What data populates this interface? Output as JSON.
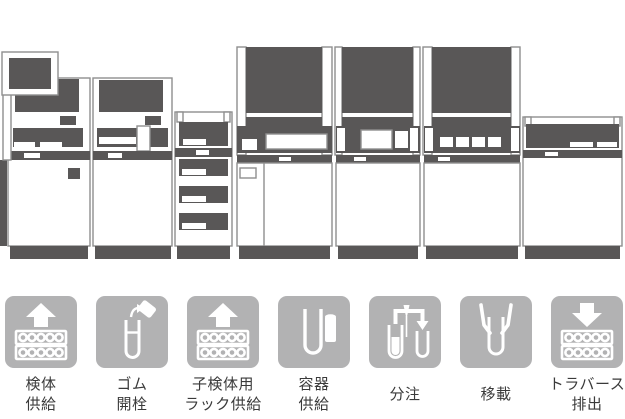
{
  "page": {
    "background": "#ffffff",
    "description_visible_content": "laboratory automation line illustration with seven process icons"
  },
  "palette": {
    "machine_dark": "#595757",
    "machine_outline": "#8f8f8f",
    "icon_tile_gray": "#b2b2b3",
    "icon_glyph": "#ffffff",
    "label_text": "#3a3a3a"
  },
  "machines": {
    "modules": [
      {
        "name": "sample-supply-unit-with-monitor"
      },
      {
        "name": "decapper-unit"
      },
      {
        "name": "rack-supply-drawer-unit"
      },
      {
        "name": "processing-unit-large-screen-1"
      },
      {
        "name": "processing-unit-large-screen-2"
      },
      {
        "name": "processing-unit-large-screen-3"
      },
      {
        "name": "traverse-output-unit"
      }
    ]
  },
  "icons": {
    "items": [
      {
        "id": "specimen-supply",
        "glyph": "arrow-up-over-sample-racks",
        "label_lines": [
          "検体",
          "供給"
        ]
      },
      {
        "id": "rubber-decapping",
        "glyph": "test-tube-cap-removal",
        "label_lines": [
          "ゴム",
          "開栓"
        ]
      },
      {
        "id": "child-specimen-rack-supply",
        "glyph": "arrow-up-over-sample-racks",
        "label_lines": [
          "子検体用",
          "ラック供給"
        ]
      },
      {
        "id": "container-supply",
        "glyph": "tube-and-container",
        "label_lines": [
          "容器",
          "供給"
        ]
      },
      {
        "id": "dispensing",
        "glyph": "tube-to-tube-pipette-arrow",
        "label_lines": [
          "分注"
        ]
      },
      {
        "id": "transfer",
        "glyph": "gripper-holding-tube",
        "label_lines": [
          "移載"
        ]
      },
      {
        "id": "traverse-discharge",
        "glyph": "arrow-down-over-sample-racks",
        "label_lines": [
          "トラバース",
          "排出"
        ]
      }
    ]
  }
}
